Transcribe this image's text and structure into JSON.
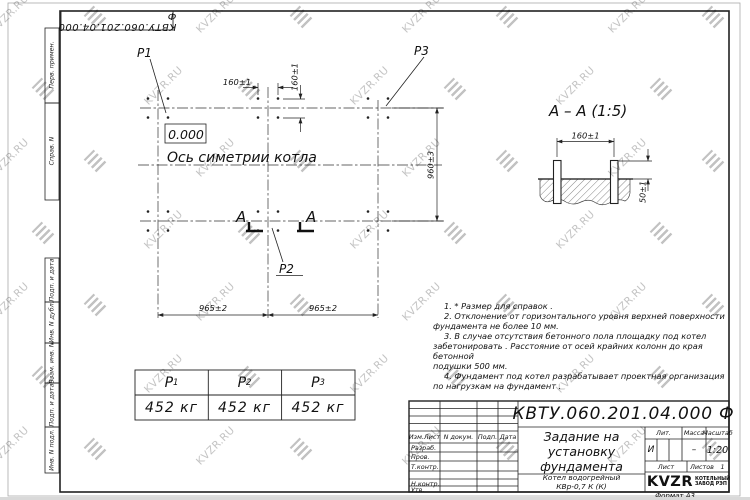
{
  "watermark": {
    "text": "KVZR.RU"
  },
  "top_stamp": {
    "doc_number": "КВТУ.060.201.04.000 Ф"
  },
  "sidebar": {
    "items": [
      "Перв. примен.",
      "Справ. N",
      "Подп. и дата",
      "Инв. N дубл.",
      "Взам. инв. N",
      "Подп. и дата",
      "Инв. N подл."
    ]
  },
  "plan": {
    "p1": "P1",
    "p2": "P2",
    "p3": "P3",
    "elevation": "0.000",
    "axis_label": "Ось симетрии котла",
    "section_letter": "А",
    "dim_160": "160±1",
    "dim_960": "960±3",
    "dim_965": "965±2"
  },
  "section_view": {
    "title": "А – А (1:5)",
    "dim_160": "160±1",
    "dim_50": "50±1"
  },
  "notes": {
    "lines": [
      "1.  * Размер для справок .",
      "2.  Отклонение от горизонтального уровня верхней поверхности",
      "фундамента не более 10 мм.",
      "3.  В случае отсутствия бетонного пола площадку под котел",
      "забетонировать . Расстояние от осей крайних колонн до края бетонной",
      "подушки  500 мм.",
      "4.  Фундамент под котел разрабатывает проектная организация",
      "по нагрузкам на фундамент ."
    ]
  },
  "weights": {
    "headers": [
      {
        "base": "Р",
        "sub": "1"
      },
      {
        "base": "Р",
        "sub": "2"
      },
      {
        "base": "Р",
        "sub": "3"
      }
    ],
    "values": [
      "452 кг",
      "452 кг",
      "452 кг"
    ]
  },
  "title_block": {
    "doc_number": "КВТУ.060.201.04.000  Ф",
    "rev_header": {
      "izm": "Изм.Лист",
      "doc": "N докум.",
      "sign": "Подп.",
      "date": "Дата"
    },
    "sign_rows": [
      "Разраб.",
      "Пров.",
      "Т.контр.",
      "Н.контр.",
      "Утв."
    ],
    "title_lines": [
      "Задание на",
      "установку",
      "фундамента"
    ],
    "product_lines": [
      "Котел водогрейный",
      "КВр-0,7 К (К)"
    ],
    "lit_label": "Лит.",
    "lit_value": "И",
    "mass_label": "Масса",
    "mass_value": "–",
    "scale_label": "Масштаб",
    "scale_value": "1:20",
    "sheet_label": "Лист",
    "sheets_label": "Листов",
    "sheets_value": "1",
    "logo_ooo": "ООО",
    "logo_name": "KVZR",
    "company_lines": [
      "КОТЕЛЬНЫЙ",
      "ЗАВОД РЭП"
    ]
  },
  "format_label": "Формат А3"
}
